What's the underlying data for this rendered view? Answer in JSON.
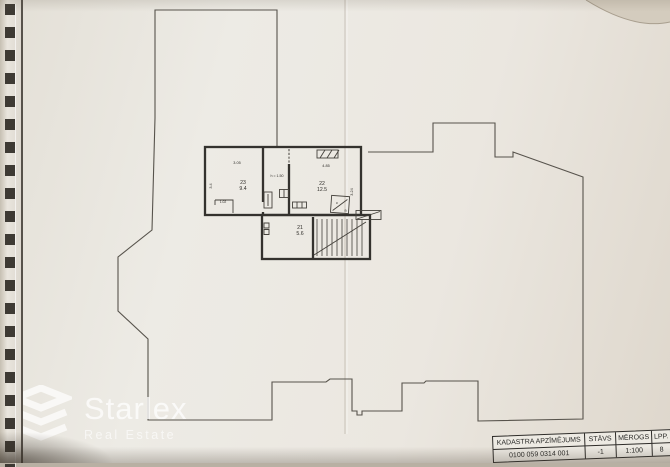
{
  "plan": {
    "rooms": [
      {
        "number": "23",
        "area": "9.4"
      },
      {
        "number": "22",
        "area": "12.5"
      },
      {
        "number": "21",
        "area": "5.6"
      }
    ],
    "annotations": {
      "passage_height": "h = 1.50",
      "dim_room23_top": "3.05",
      "dim_room23_left": "3.4",
      "dim_room23_niche": "1.02",
      "dim_room22_top": "4.85",
      "dim_room22_right": "3.24",
      "shower_letter_c": "c",
      "shower_letter_a": "a"
    }
  },
  "title_block": {
    "headers": [
      "KADASTRA APZĪMĒJUMS",
      "STĀVS",
      "MĒROGS",
      "LPP."
    ],
    "values": [
      "0100 059 0314 001",
      "-1",
      "1:100",
      "8"
    ]
  },
  "watermark": {
    "brand": "Starlex",
    "sub": "Real Estate"
  },
  "colors": {
    "paper": "#ebe7e0",
    "outline": "#57534c",
    "wall": "#34322e",
    "watermark": "#ffffff"
  }
}
